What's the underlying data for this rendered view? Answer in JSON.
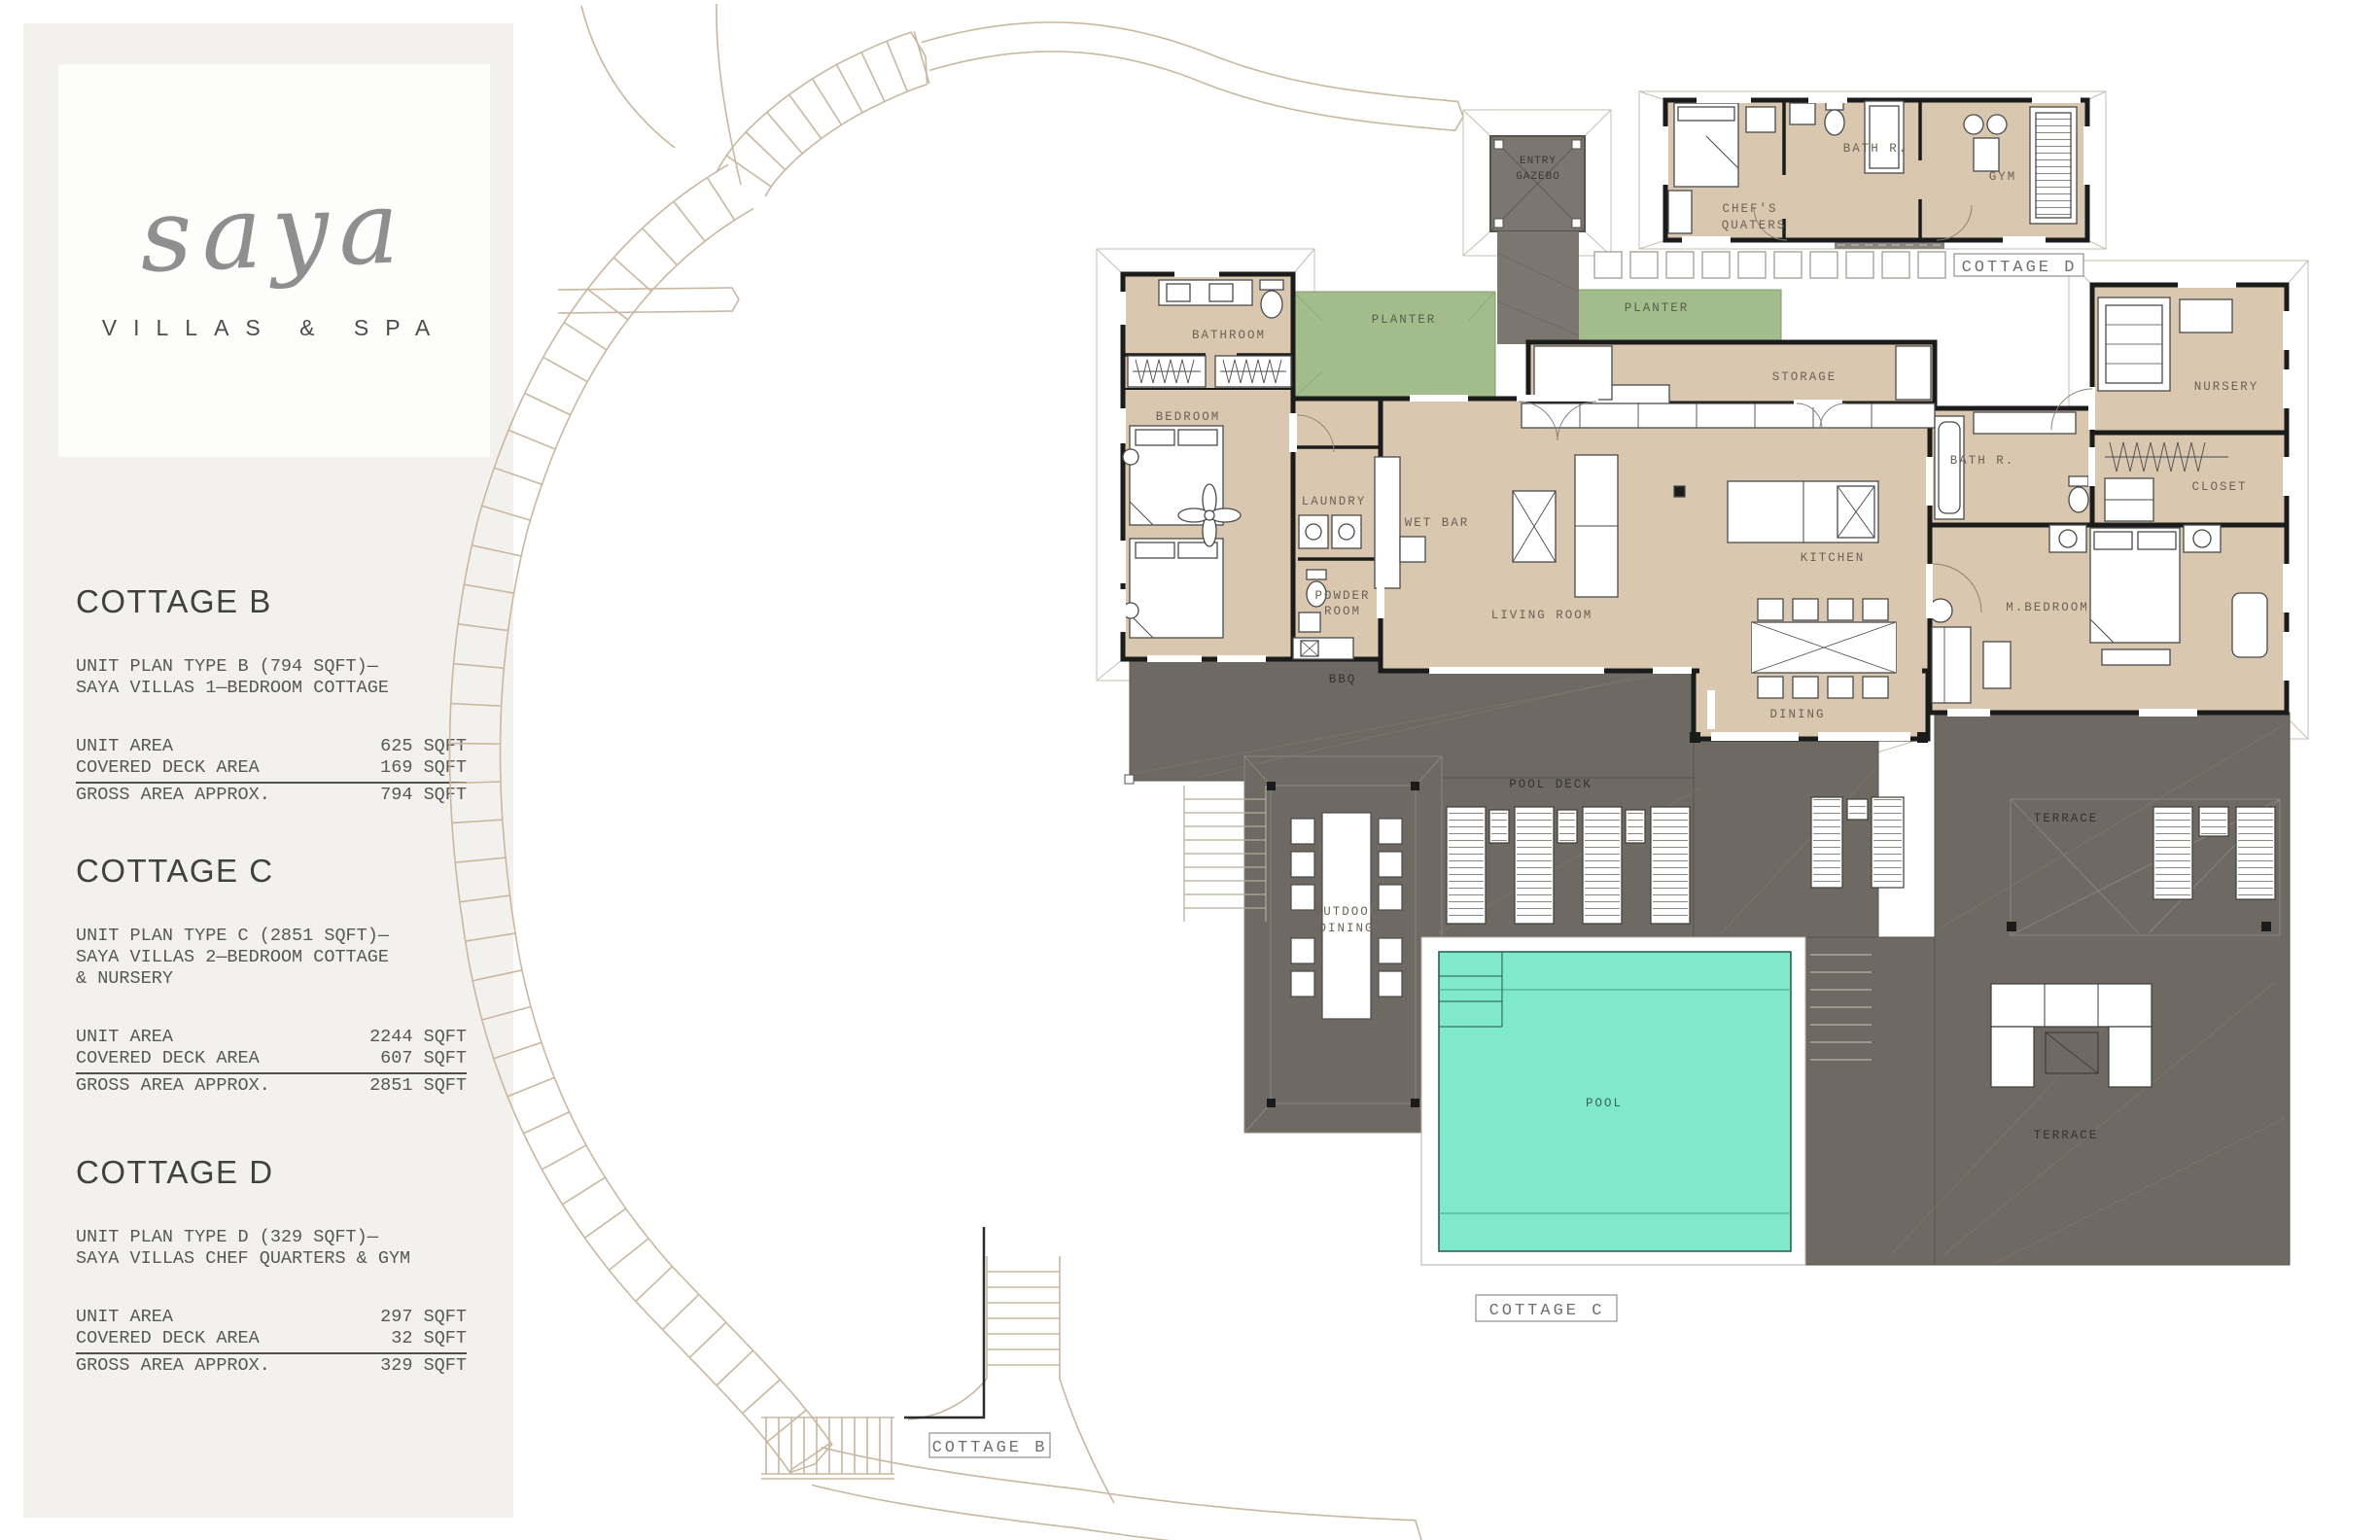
{
  "sidebar": {
    "logo": {
      "brand": "saya",
      "tagline": "VILLAS & SPA"
    },
    "sections": [
      {
        "title": "COTTAGE B",
        "desc": [
          "UNIT PLAN TYPE B (794 SQFT)—",
          "SAYA VILLAS 1—BEDROOM COTTAGE"
        ],
        "rows": [
          {
            "label": "UNIT AREA",
            "value": "625 SQFT"
          },
          {
            "label": "COVERED DECK AREA",
            "value": "169 SQFT"
          }
        ],
        "total": {
          "label": "GROSS AREA APPROX.",
          "value": "794 SQFT"
        }
      },
      {
        "title": "COTTAGE C",
        "desc": [
          "UNIT PLAN TYPE C (2851 SQFT)—",
          "SAYA VILLAS 2—BEDROOM COTTAGE",
          "& NURSERY"
        ],
        "rows": [
          {
            "label": "UNIT AREA",
            "value": "2244 SQFT"
          },
          {
            "label": "COVERED DECK AREA",
            "value": "607 SQFT"
          }
        ],
        "total": {
          "label": "GROSS AREA APPROX.",
          "value": "2851 SQFT"
        }
      },
      {
        "title": "COTTAGE D",
        "desc": [
          "UNIT PLAN TYPE D (329 SQFT)—",
          "SAYA VILLAS CHEF QUARTERS & GYM"
        ],
        "rows": [
          {
            "label": "UNIT AREA",
            "value": "297 SQFT"
          },
          {
            "label": "COVERED DECK AREA",
            "value": "32 SQFT"
          }
        ],
        "total": {
          "label": "GROSS AREA APPROX.",
          "value": "329 SQFT"
        }
      }
    ]
  },
  "plan": {
    "labels": {
      "entry_gazebo": [
        "ENTRY",
        "GAZEBO"
      ],
      "chefs_quarters": [
        "CHEF'S",
        "QUATERS"
      ],
      "bath_r": "BATH R.",
      "gym": "GYM",
      "planter": "PLANTER",
      "bathroom": "BATHROOM",
      "bedroom": "BEDROOM",
      "laundry": "LAUNDRY",
      "wet_bar": "WET BAR",
      "powder_room": [
        "POWDER",
        "ROOM"
      ],
      "living_room": "LIVING ROOM",
      "storage": "STORAGE",
      "kitchen": "KITCHEN",
      "dining": "DINING",
      "m_bedroom": "M.BEDROOM",
      "nursery": "NURSERY",
      "closet": "CLOSET",
      "bbq": "BBQ",
      "pool_deck": "POOL DECK",
      "outdoor_dining": [
        "OUTDOOR",
        "DINING"
      ],
      "pool": "POOL",
      "terrace": "TERRACE",
      "tags": {
        "cottage_b": "COTTAGE B",
        "cottage_c": "COTTAGE C",
        "cottage_d": "COTTAGE D"
      }
    },
    "colors": {
      "floor": "#d9c7af",
      "deck": "#6e6a63",
      "walk": "#7b7670",
      "planter": "#a2bd8b",
      "pool": "#7fe9cc",
      "wall": "#1b1b1b",
      "path": "#c9b7a0",
      "sidebar": "#f2f1ee"
    }
  }
}
